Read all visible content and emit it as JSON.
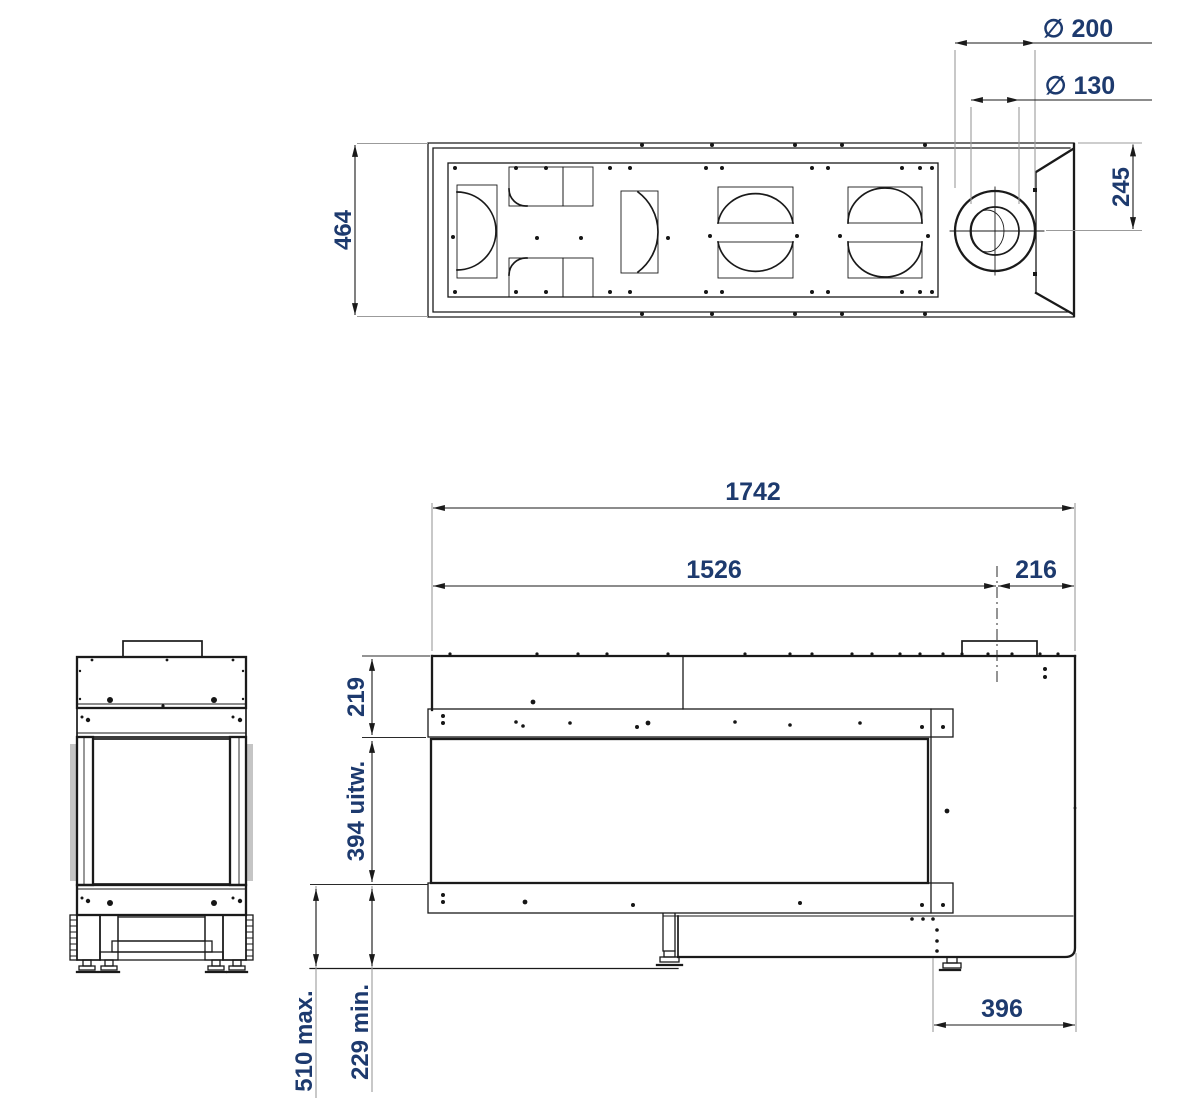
{
  "labels": {
    "dia_outer": "∅ 200",
    "dia_inner": "∅ 130",
    "plan_depth": "464",
    "flue_center_from_top_edge": "245",
    "overall_length": "1742",
    "front_section_length": "1526",
    "flue_center_from_right": "216",
    "top_to_window": "219",
    "window_height": "394 uitw.",
    "floor_clearance_max": "510 max.",
    "floor_clearance_min": "229 min.",
    "right_section_depth": "396"
  },
  "colors": {
    "dimension_text": "#1d3a6e",
    "line": "#1a1a1a",
    "extension_line": "#9b9b9b",
    "glass_shade": "#c5c5c5",
    "background": "#ffffff"
  }
}
